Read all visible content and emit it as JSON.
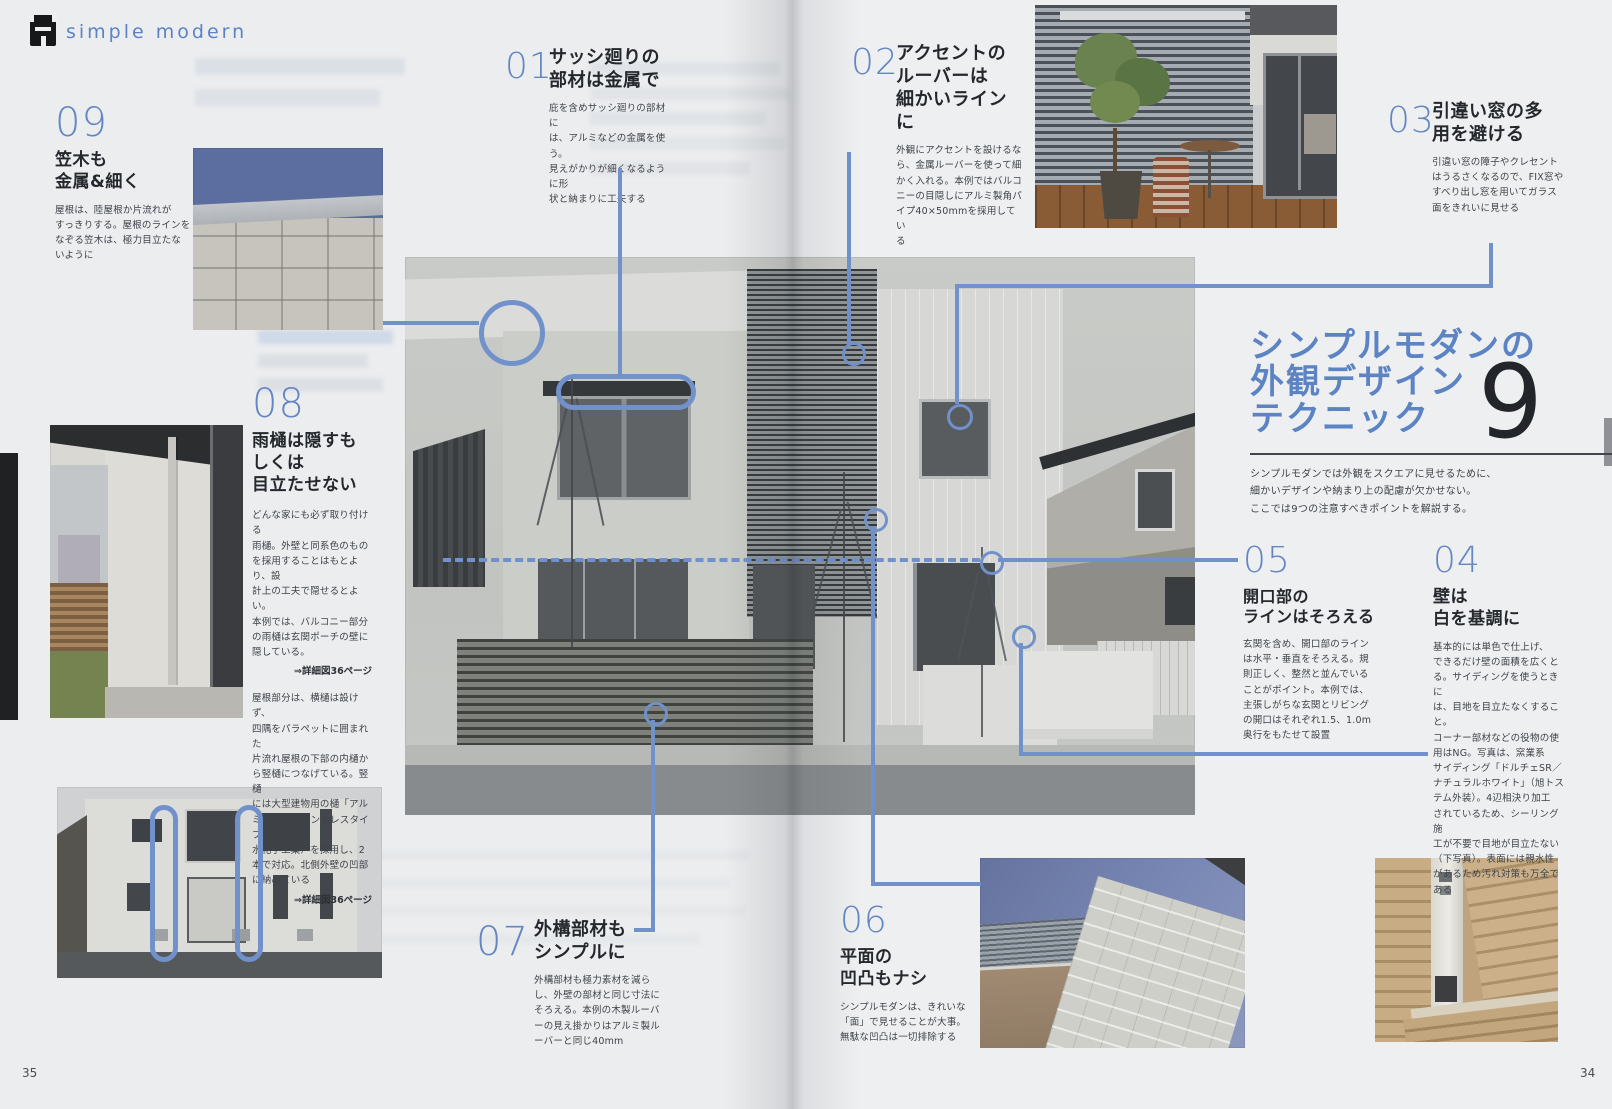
{
  "colors": {
    "accent_blue": "#6487c3",
    "callout_blue": "#7191cb",
    "big_number_dark": "#22262b",
    "body_text": "#3e4349"
  },
  "header": {
    "brand": "simple modern"
  },
  "page_numbers": {
    "left": "35",
    "right": "34"
  },
  "title_block": {
    "title": "シンプルモダンの\n外観デザイン\nテクニック",
    "count": "9",
    "intro": "シンプルモダンでは外観をスクエアに見せるために、\n細かいデザインや納まり上の配慮が欠かせない。\nここでは9つの注意すべきポイントを解説する。"
  },
  "tips": [
    {
      "number": "01",
      "heading": "サッシ廻りの\n部材は金属で",
      "body": "庇を含めサッシ廻りの部材に\nは、アルミなどの金属を使う。\n見えがかりが細くなるように形\n状と納まりに工夫する"
    },
    {
      "number": "02",
      "heading": "アクセントの\nルーバーは\n細かいラインに",
      "body": "外観にアクセントを設けるな\nら、金属ルーバーを使って細\nかく入れる。本例ではバルコ\nニーの目隠しにアルミ製角パ\nイプ40×50mmを採用してい\nる"
    },
    {
      "number": "03",
      "heading": "引違い窓の多\n用を避ける",
      "body": "引違い窓の障子やクレセント\nはうるさくなるので、FIX窓や\nすべり出し窓を用いてガラス\n面をきれいに見せる"
    },
    {
      "number": "04",
      "heading": "壁は\n白を基調に",
      "body": "基本的には単色で仕上げ、\nできるだけ壁の面積を広くと\nる。サイディングを使うときに\nは、目地を目立たなくすること。\nコーナー部材などの役物の使\n用はNG。写真は、窯業系\nサイディング「ドルチェSR／\nナチュラルホワイト」（旭トス\nテム外装）。4辺相決り加工\nされているため、シーリング施\n工が不要で目地が目立たない\n（下写真）。表面には親水性\nがあるため汚れ対策も万全で\nある"
    },
    {
      "number": "05",
      "heading": "開口部の\nラインはそろえる",
      "body": "玄関を含め、開口部のライン\nは水平・垂直をそろえる。規\n則正しく、整然と並んでいる\nことがポイント。本例では、\n主張しがちな玄関とリビング\nの開口はそれぞれ1.5、1.0m\n奥行をもたせて設置"
    },
    {
      "number": "06",
      "heading": "平面の\n凹凸もナシ",
      "body": "シンプルモダンは、きれいな\n「面」で見せることが大事。\n無駄な凹凸は一切排除する"
    },
    {
      "number": "07",
      "heading": "外構部材も\nシンプルに",
      "body": "外構部材も極力素材を減ら\nし、外壁の部材と同じ寸法に\nそろえる。本例の木製ルーバ\nーの見え掛かりはアルミ製ル\nーバーと同じ40mm"
    },
    {
      "number": "08",
      "heading": "雨樋は隠すも\nしくは\n目立たせない",
      "body": "どんな家にも必ず取り付ける\n雨樋。外壁と同系色のもの\nを採用することはもとより、設\n計上の工夫で隠せるとよい。\n本例では、バルコニー部分\nの雨樋は玄関ポーチの壁に\n隠している。",
      "note": "⇒詳細図36ページ",
      "body2": "屋根部分は、横樋は設けず、\n四隅をパラペットに囲まれた\n片流れ屋根の下部の内樋か\nら竪樋につなげている。竪樋\nには大型建物用の樋「アル\nミライン・バンドレスタイプ」（積\n水化学工業）を採用し、2\n本で対応。北側外壁の凹部\nに納めている",
      "note2": "⇒詳細図36ページ"
    },
    {
      "number": "09",
      "heading": "笠木も\n金属&細く",
      "body": "屋根は、陸屋根か片流れが\nすっきりする。屋根のラインを\nなぞる笠木は、極力目立たな\nいように"
    }
  ]
}
